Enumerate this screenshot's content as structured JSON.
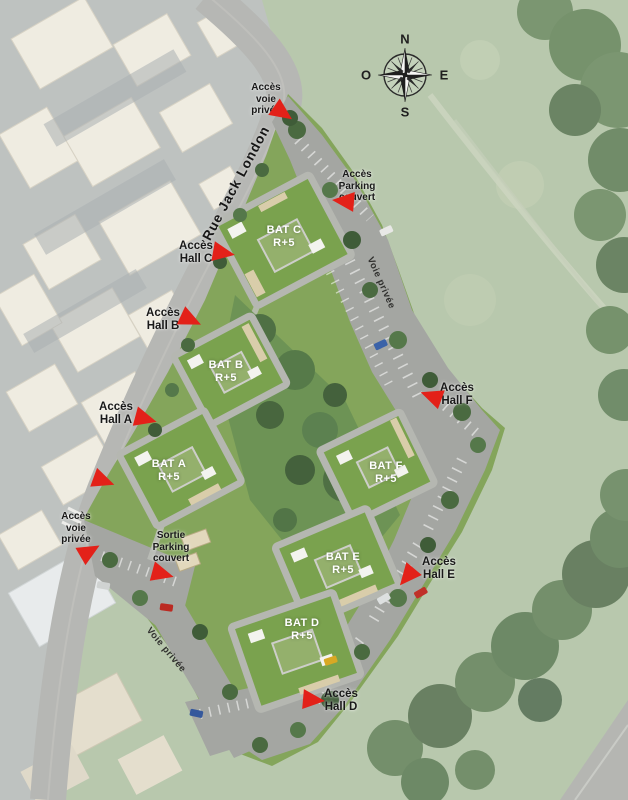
{
  "map_title": "Plan de masse résidence - Rue Jack London",
  "compass": {
    "north": "N",
    "east": "E",
    "south": "S",
    "west": "O"
  },
  "street": {
    "name": "Rue Jack London"
  },
  "private_roads": {
    "east_label": "Voie privée",
    "south_label": "Voie privée"
  },
  "buildings": [
    {
      "name": "BAT C",
      "floors": "R+5"
    },
    {
      "name": "BAT B",
      "floors": "R+5"
    },
    {
      "name": "BAT A",
      "floors": "R+5"
    },
    {
      "name": "BAT F",
      "floors": "R+5"
    },
    {
      "name": "BAT E",
      "floors": "R+5"
    },
    {
      "name": "BAT D",
      "floors": "R+5"
    }
  ],
  "access_labels": {
    "voie_privee_nord": "Accès\nvoie\nprivée",
    "parking_couvert": "Accès\nParking\ncouvert",
    "hall_c": "Accès\nHall C",
    "hall_b": "Accès\nHall B",
    "hall_a": "Accès\nHall A",
    "hall_f": "Accès\nHall F",
    "voie_privee_sud": "Accès\nvoie\nprivée",
    "sortie_parking_couvert": "Sortie\nParking\ncouvert",
    "hall_e": "Accès\nHall E",
    "hall_d": "Accès\nHall D"
  },
  "colors": {
    "arrow_red": "#e32119",
    "field_green": "#a9bc9c",
    "site_lawn": "#84a55b",
    "roof_green": "#7aa24e",
    "parking_gray": "#a4a6a2",
    "label_black": "#191919",
    "label_white": "#ffffff"
  }
}
